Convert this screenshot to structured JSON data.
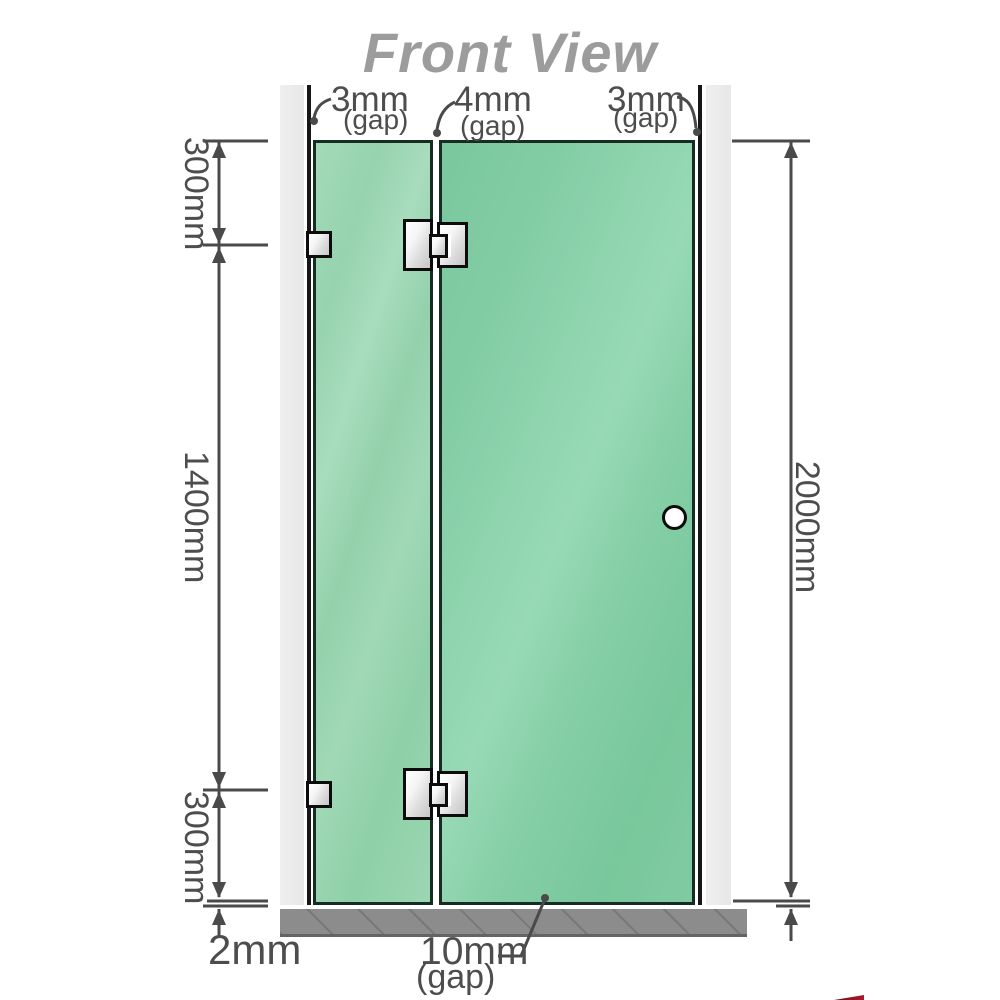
{
  "title": "Front View",
  "top_gaps": [
    {
      "value": "3mm",
      "note": "(gap)"
    },
    {
      "value": "4mm",
      "note": "(gap)"
    },
    {
      "value": "3mm",
      "note": "(gap)"
    }
  ],
  "left_dims": {
    "top": "300mm",
    "middle": "1400mm",
    "bottom": "300mm"
  },
  "right_dims": {
    "height": "2000mm"
  },
  "bottom_dims": {
    "floor_gap": "2mm",
    "door_gap": {
      "value": "10mm",
      "note": "(gap)"
    }
  },
  "colors": {
    "glass": "#7cc9a0",
    "glass_light": "#9dd6b4",
    "wall": "#ebebeb",
    "floor": "#8c8c8c",
    "dimension_line": "#4a4a4a",
    "title_text": "#9c9c9c",
    "hardware_metal": "#e9e9e9"
  }
}
